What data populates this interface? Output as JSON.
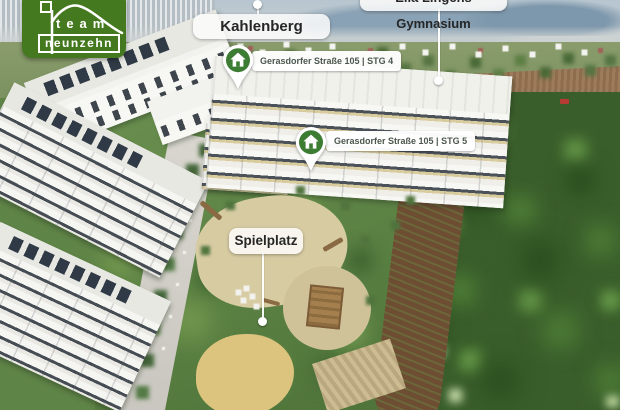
{
  "logo": {
    "line1": "team",
    "line2": "neunzehn"
  },
  "map_labels": {
    "kahlenberg": "Kahlenberg",
    "gymnasium": "Ella Lingens Gymnasium",
    "address_stg4": "Gerasdorfer Straße 105 | STG 4",
    "address_stg5": "Gerasdorfer Straße 105 | STG 5",
    "spielplatz": "Spielplatz"
  },
  "colors": {
    "brand_green": "#45791f",
    "pin_green": "#3d7c33",
    "address_text": "#4b574c",
    "pill_text": "#262626",
    "leader_line": "#ffffff"
  }
}
